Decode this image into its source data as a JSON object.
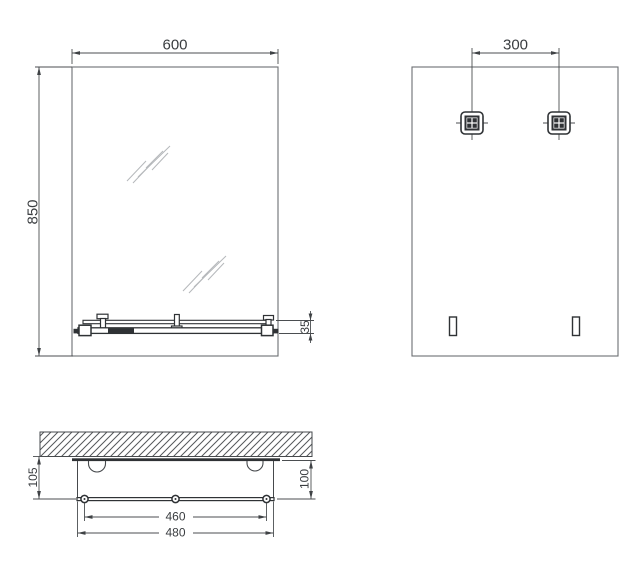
{
  "drawing": {
    "front_view": {
      "width_dim": "600",
      "height_dim": "850",
      "shelf_thickness_dim": "35"
    },
    "back_view": {
      "bracket_spacing_dim": "300"
    },
    "plan_view": {
      "depth_from_wall_dim": "105",
      "depth_from_mirror_dim": "100",
      "bracket_span_dim": "460",
      "shelf_width_dim": "480"
    },
    "colors": {
      "line": "#46494c",
      "dim_line": "#4b4e51",
      "bold_line": "#2f3235",
      "mirror_edge": "#6b6e72",
      "shine": "#b5b8bb",
      "text": "#3a3d40",
      "background": "#ffffff"
    }
  }
}
